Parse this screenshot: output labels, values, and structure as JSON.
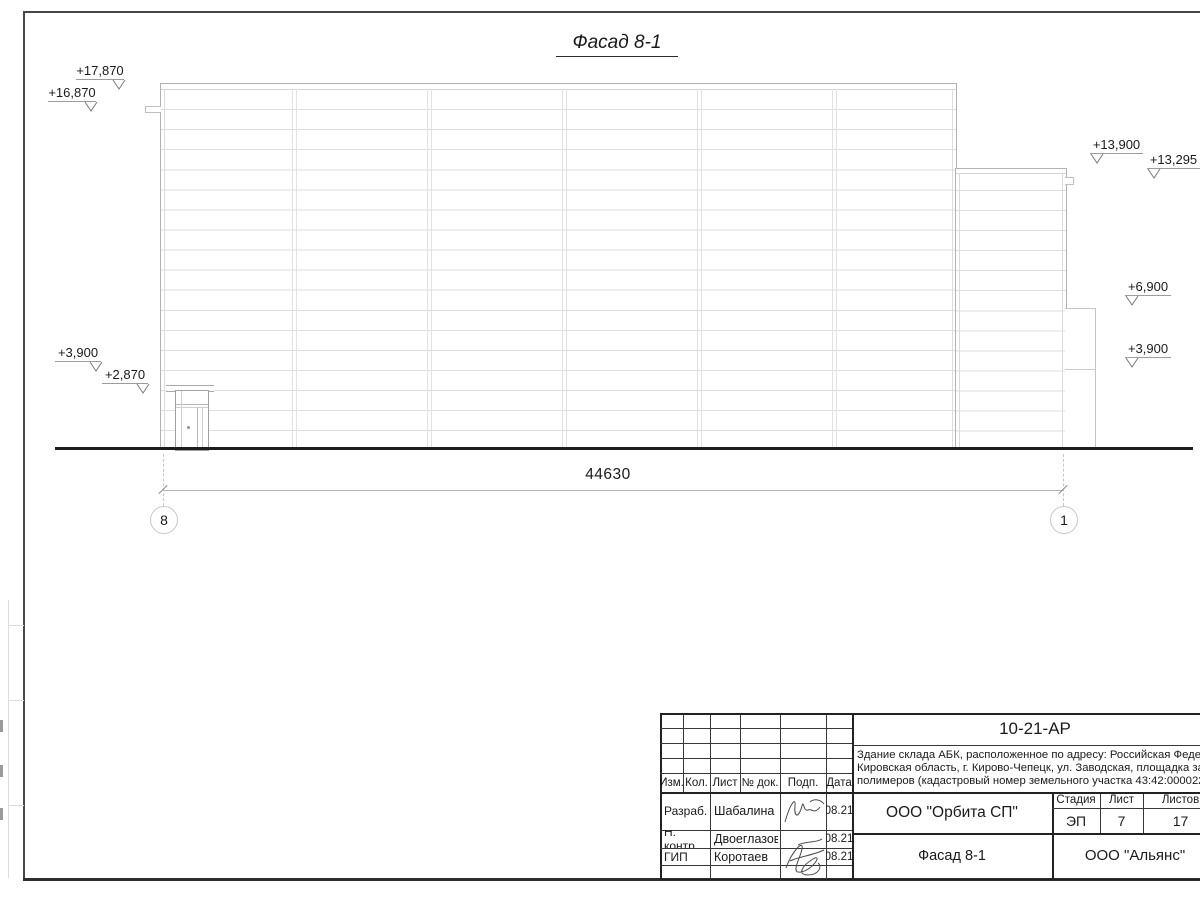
{
  "drawing": {
    "title": "Фасад 8-1",
    "dimension_value": "44630",
    "axis_left": "8",
    "axis_right": "1",
    "elevations": [
      {
        "label": "+17,870"
      },
      {
        "label": "+16,870"
      },
      {
        "label": "+13,900"
      },
      {
        "label": "+13,295"
      },
      {
        "label": "+6,900"
      },
      {
        "label": "+3,900"
      },
      {
        "label": "+3,900"
      },
      {
        "label": "+2,870"
      }
    ]
  },
  "title_block": {
    "doc_number": "10-21-АР",
    "description_lines": [
      "Здание склада АБК, расположенное по адресу: Российская Федераци",
      "Кировская область, г. Кирово-Чепецк, ул. Заводская, площадка заво",
      "полимеров (кадастровый номер земельного участка 43:42:000022:"
    ],
    "col_headers": {
      "izm": "Изм.",
      "kol": "Кол.",
      "list": "Лист",
      "doc": "№ док.",
      "podp": "Подп.",
      "data": "Дата"
    },
    "signature_rows": [
      {
        "role": "Разраб.",
        "name": "Шабалина",
        "date": "08.21"
      },
      {
        "role": "Н. контр.",
        "name": "Двоеглазов",
        "date": "08.21"
      },
      {
        "role": "ГИП",
        "name": "Коротаев",
        "date": "08.21"
      }
    ],
    "stage_header": "Стадия",
    "sheet_header": "Лист",
    "sheets_header": "Листов",
    "stage_value": "ЭП",
    "sheet_value": "7",
    "sheets_value": "17",
    "organization": "ООО \"Орбита СП\"",
    "sheet_title": "Фасад 8-1",
    "customer": "ООО \"Альянс\""
  }
}
